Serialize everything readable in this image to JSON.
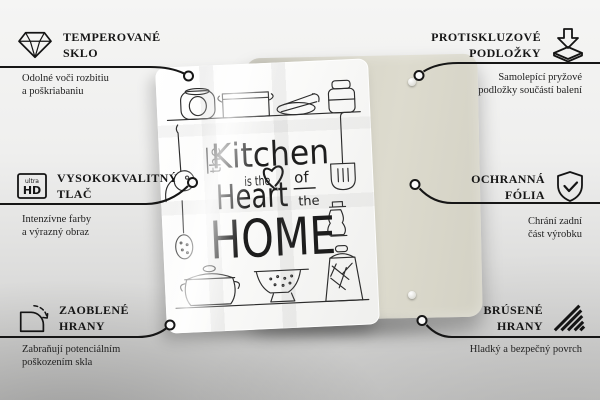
{
  "board": {
    "quote": {
      "word_the_1": "the",
      "word_kitchen": "Kitchen",
      "word_is_the": "is the",
      "word_of": "of",
      "word_the_2": "the",
      "word_heart": "Heart",
      "word_home": "HOME",
      "heart_icon": "heart-icon"
    }
  },
  "callouts": {
    "left": [
      {
        "icon": "diamond-icon",
        "title_line1": "TEMPEROVANÉ",
        "title_line2": "SKLO",
        "subtitle_line1": "Odolné voči rozbitiu",
        "subtitle_line2": "a poškriabaniu"
      },
      {
        "icon": "ultra-hd-icon",
        "icon_text_small": "ultra",
        "icon_text_big": "HD",
        "title_line1": "VYSOKOKVALITNÝ",
        "title_line2": "TLAČ",
        "subtitle_line1": "Intenzívne farby",
        "subtitle_line2": "a výrazný obraz"
      },
      {
        "icon": "rounded-corner-icon",
        "title_line1": "ZAOBLENÉ",
        "title_line2": "HRANY",
        "subtitle_line1": "Zabraňují potenciálním",
        "subtitle_line2": "poškozením skla"
      }
    ],
    "right": [
      {
        "icon": "anti-slip-pad-icon",
        "title_line1": "PROTISKLUZOVÉ",
        "title_line2": "PODLOŽKY",
        "subtitle_line1": "Samolepící pryžové",
        "subtitle_line2": "podložky součástí balení"
      },
      {
        "icon": "shield-check-icon",
        "title_line1": "OCHRANNÁ",
        "title_line2": "FÓLIA",
        "subtitle_line1": "Chrání zadní",
        "subtitle_line2": "část výrobku"
      },
      {
        "icon": "ground-edges-icon",
        "title_line1": "BRÚSENÉ",
        "title_line2": "HRANY",
        "subtitle_line1": "Hladký a bezpečný povrch",
        "subtitle_line2": ""
      }
    ]
  },
  "colors": {
    "line": "#1a1a1a",
    "backing_board": "#d8d6c9",
    "glass": "#ffffff",
    "background_top": "#f5f5f4",
    "background_bottom": "#c9c9c8"
  }
}
